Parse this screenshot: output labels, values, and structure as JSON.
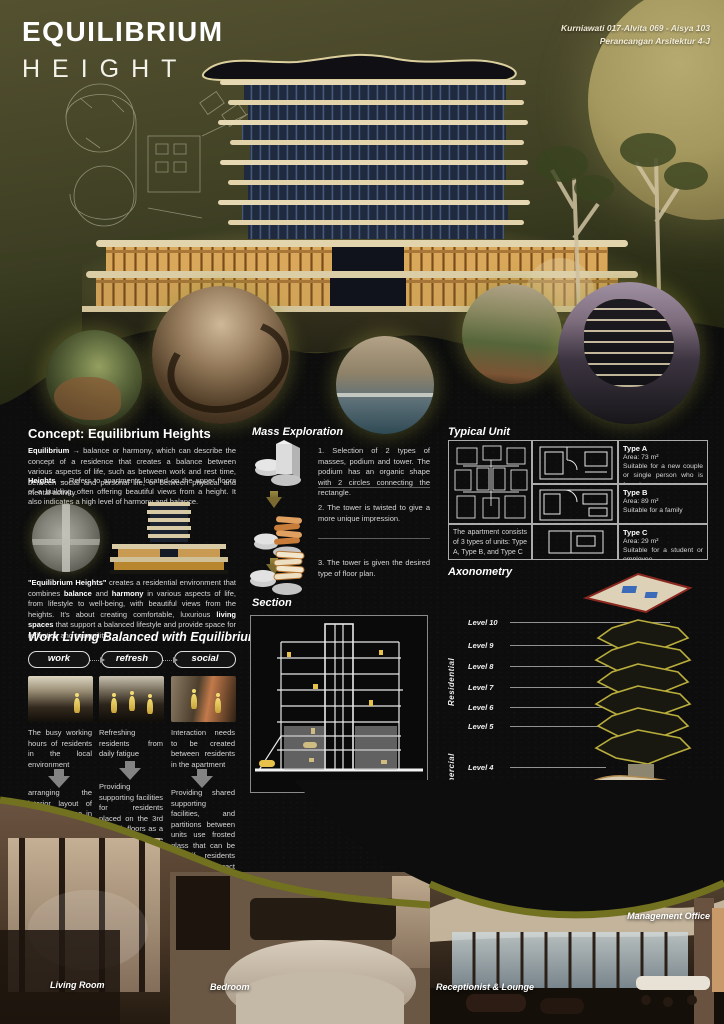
{
  "header": {
    "title_line1": "EQUILIBRIUM",
    "title_line2": "HEIGHT",
    "credits_line1": "Kurniawati 017-Alvita 069 - Aisya 103",
    "credits_line2": "Perancangan Arsitektur 4-J"
  },
  "concept": {
    "heading": "Concept: Equilibrium Heights",
    "paragraph1": [
      {
        "text": "Equilibrium",
        "bold": true
      },
      {
        "text": " → balance or harmony, which can describe the concept of a residence that creates a balance between various aspects of life, such as between work and rest time, between social and personal life, or between physical and mental activity.",
        "bold": false
      }
    ],
    "paragraph2": [
      {
        "text": "Heights",
        "bold": true
      },
      {
        "text": " → Refers to apartments located on the upper floors of a building, often offering beautiful views from a height. It also indicates a high level of harmony and balance.",
        "bold": false
      }
    ],
    "paragraph3": [
      {
        "text": "\"Equilibrium Heights\"",
        "bold": true
      },
      {
        "text": " creates a residential environment that combines ",
        "bold": false
      },
      {
        "text": "balance",
        "bold": true
      },
      {
        "text": " and ",
        "bold": false
      },
      {
        "text": "harmony",
        "bold": true
      },
      {
        "text": " in various aspects of life, from lifestyle to well-being, with beautiful views from the heights. It's about creating comfortable, luxurious ",
        "bold": false
      },
      {
        "text": "living spaces",
        "bold": true
      },
      {
        "text": " that support a balanced lifestyle and provide space for reflection and tranquility.",
        "bold": false
      }
    ]
  },
  "mass_exploration": {
    "heading": "Mass Exploration",
    "steps": [
      {
        "text": "1. Selection of 2 types of masses, podium and tower. The podium has an organic shape with 2 circles connecting the rectangle."
      },
      {
        "text": "2. The tower is twisted to give a more unique impression."
      },
      {
        "text": "3. The tower is given the desired type of floor plan."
      }
    ]
  },
  "section": {
    "heading": "Section"
  },
  "typical_unit": {
    "heading": "Typical Unit",
    "caption": "The apartment consists of 3 types of units: Type A, Type B, and Type C",
    "types": [
      {
        "name": "Type A",
        "area": "Area: 73 m²",
        "desc": "Suitable for a new couple or single person who is focusing on a career"
      },
      {
        "name": "Type B",
        "area": "Area: 89 m²",
        "desc": "Suitable for a family"
      },
      {
        "name": "Type C",
        "area": "Area: 29 m²",
        "desc": "Suitable for a student or employee"
      }
    ]
  },
  "axonometry": {
    "heading": "Axonometry",
    "groups": [
      {
        "label": "Residential"
      },
      {
        "label": "Commercial"
      },
      {
        "label": "Public Space"
      }
    ],
    "levels": [
      {
        "label": "Level 10"
      },
      {
        "label": "Level 9"
      },
      {
        "label": "Level 8"
      },
      {
        "label": "Level 7"
      },
      {
        "label": "Level 6"
      },
      {
        "label": "Level 5"
      },
      {
        "label": "Level 4"
      },
      {
        "label": "Level 3"
      },
      {
        "label": "Level 2"
      },
      {
        "label": "Level 1"
      }
    ]
  },
  "work_living": {
    "heading": "Work Living Balanced with Equilibrium Heights",
    "pills": [
      {
        "label": "work"
      },
      {
        "label": "refresh"
      },
      {
        "label": "social"
      }
    ],
    "columns": [
      {
        "top": "The busy working hours of residents in the local environment",
        "bottom": "arranging the interior layout of the work space in each unit, especially type A which has its own work space in that unit."
      },
      {
        "top": "Refreshing residents from daily fatigue",
        "bottom": "Providing supporting facilities for residents placed on the 3rd and 4th floors as a refreshing place for residents unit."
      },
      {
        "top": "Interaction needs to be created between residents in the apartment",
        "bottom": "Providing shared supporting facilities, and partitions between units use frosted glass that can be slid if residents want to interact with each other"
      }
    ]
  },
  "photos": {
    "living_room": "Living Room",
    "bedroom": "Bedroom",
    "receptionist": "Receptionist & Lounge",
    "management": "Management Office"
  },
  "colors": {
    "olive_rim": "#71711f",
    "hero_olive": "#474629",
    "moon": "#a4985e",
    "cream": "#e6d8b2",
    "accent_yellow": "#e8c14a",
    "pool_blue": "#4a9ac8"
  }
}
